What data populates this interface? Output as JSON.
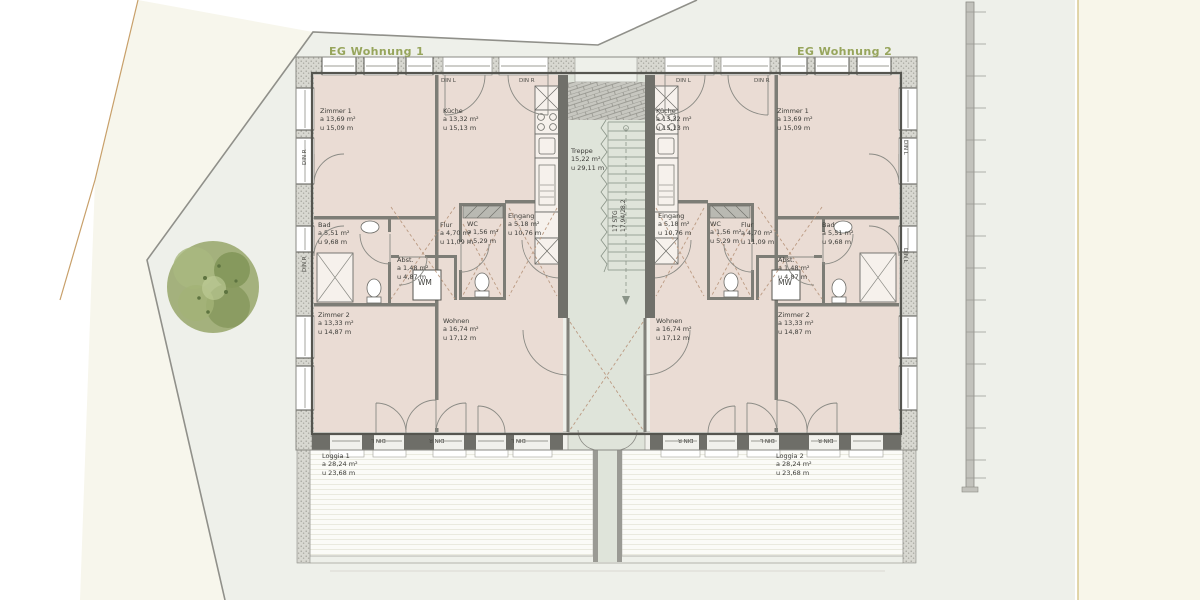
{
  "plan": {
    "title_left": "EG Wohnung 1",
    "title_right": "EG Wohnung 2",
    "colors": {
      "accent_green": "#97a55c",
      "room_fill": "#eadcd4",
      "stair_fill": "#dfe4da",
      "site_cream": "#f7f6ec",
      "site_grey": "#eef0ea",
      "wall_dark": "#55554f"
    }
  },
  "stairwell": {
    "name": "Treppe",
    "area": "15,22 m²",
    "perimeter": "u 29,11 m",
    "steps_line1": "17 STG",
    "steps_line2": "17,94/28,2"
  },
  "window_labels": {
    "left": "DIN L",
    "right": "DIN R"
  },
  "apartment1": {
    "washer_label": "WM",
    "rooms": {
      "zimmer1": {
        "name": "Zimmer 1",
        "area": "a 13,69 m²",
        "perimeter": "u 15,09 m"
      },
      "kueche": {
        "name": "Küche",
        "area": "a 13,32 m²",
        "perimeter": "u 15,13 m"
      },
      "bad": {
        "name": "Bad",
        "area": "a 5,51 m²",
        "perimeter": "u 9,68 m"
      },
      "flur": {
        "name": "Flur",
        "area": "a 4,70 m²",
        "perimeter": "u 11,09 m"
      },
      "wc": {
        "name": "WC",
        "area": "a 1,56 m²",
        "perimeter": "u 5,29 m"
      },
      "eingang": {
        "name": "Eingang",
        "area": "a 5,18 m²",
        "perimeter": "u 10,76 m"
      },
      "abst": {
        "name": "Abst.",
        "area": "a 1,48 m²",
        "perimeter": "u 4,87 m"
      },
      "zimmer2": {
        "name": "Zimmer 2",
        "area": "a 13,33 m²",
        "perimeter": "u 14,87 m"
      },
      "wohnen": {
        "name": "Wohnen",
        "area": "a 16,74 m²",
        "perimeter": "u 17,12 m"
      },
      "loggia": {
        "name": "Loggia 1",
        "area": "a 28,24 m²",
        "perimeter": "u 23,68 m"
      }
    }
  },
  "apartment2": {
    "washer_label": "MW",
    "rooms": {
      "zimmer1": {
        "name": "Zimmer 1",
        "area": "a 13,69 m²",
        "perimeter": "u 15,09 m"
      },
      "kueche": {
        "name": "Küche",
        "area": "a 13,32 m²",
        "perimeter": "u 15,13 m"
      },
      "bad": {
        "name": "Bad",
        "area": "a 5,51 m²",
        "perimeter": "u 9,68 m"
      },
      "flur": {
        "name": "Flur",
        "area": "a 4,70 m²",
        "perimeter": "u 11,09 m"
      },
      "wc": {
        "name": "WC",
        "area": "a 1,56 m²",
        "perimeter": "u 5,29 m"
      },
      "eingang": {
        "name": "Eingang",
        "area": "a 5,18 m²",
        "perimeter": "u 10,76 m"
      },
      "abst": {
        "name": "Abst.",
        "area": "a 1,48 m²",
        "perimeter": "u 4,87 m"
      },
      "zimmer2": {
        "name": "Zimmer 2",
        "area": "a 13,33 m²",
        "perimeter": "u 14,87 m"
      },
      "wohnen": {
        "name": "Wohnen",
        "area": "a 16,74 m²",
        "perimeter": "u 17,12 m"
      },
      "loggia": {
        "name": "Loggia 2",
        "area": "a 28,24 m²",
        "perimeter": "u 23,68 m"
      }
    }
  }
}
